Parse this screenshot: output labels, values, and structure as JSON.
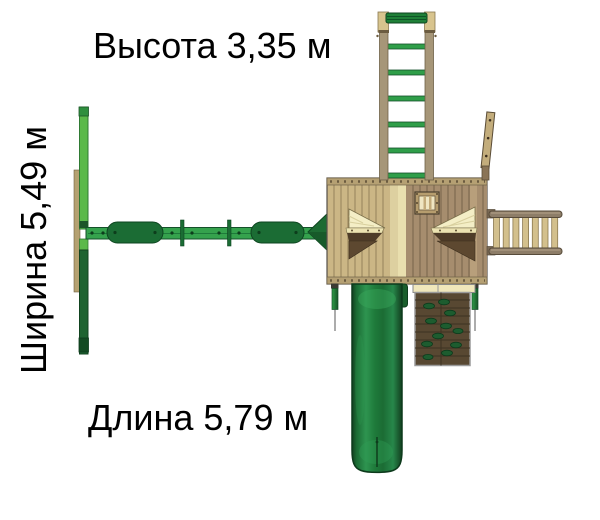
{
  "labels": {
    "height": "Высота 3,35 м",
    "width": "Ширина 5,49 м",
    "length": "Длина 5,79 м"
  },
  "dimensions": {
    "height_m": "3,35",
    "width_m": "5,49",
    "length_m": "5,79",
    "unit": "м"
  },
  "illustration": {
    "type": "playground-set-top-view",
    "components": [
      "swing-frame-end",
      "swing-beam",
      "swing-seats",
      "beam-brace-triangle",
      "playhouse-roof",
      "roof-window",
      "canopy-corner-left",
      "canopy-corner-right",
      "vertical-ladder",
      "flag-plank",
      "access-ladder",
      "tube-slide",
      "climbing-wall"
    ],
    "colors": {
      "light_green": "#5bb94a",
      "medium_green": "#2f9e49",
      "dark_green": "#1b6c34",
      "deep_green": "#123f1f",
      "wood_light": "#cbb685",
      "wood_dark": "#a68d6e",
      "cream": "#f4eec6",
      "dark_brown": "#5d4830",
      "wall_brown": "#584832",
      "rung_tan": "#d3c08d",
      "text": "#000000",
      "background": "#ffffff"
    }
  }
}
